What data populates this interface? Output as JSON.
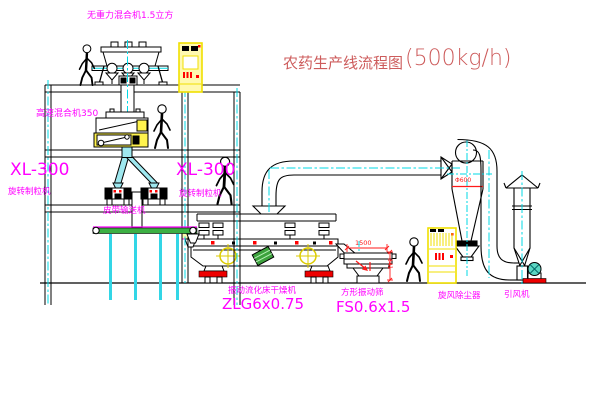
{
  "title": {
    "text": "农药生产线流程图",
    "capacity": "(500kg/h)"
  },
  "labels": {
    "mixer_top": "无重力混合机1.5立方",
    "mixer_highspeed": "高速混合机350",
    "granulator_left_model": "XL-300",
    "granulator_left_name": "旋转制粒机",
    "granulator_right_model": "XL-300",
    "granulator_right_name": "旋转制粒机",
    "belt_conveyor": "皮带输送机",
    "dryer_name": "振动流化床干燥机",
    "dryer_model": "ZLG6x0.75",
    "screen_name": "方形振动筛",
    "screen_model": "FS0.6x1.5",
    "cyclone": "旋风除尘器",
    "fan": "引风机"
  },
  "dimensions": {
    "cyclone_dia": "Φ600",
    "screen_length": "1500",
    "screen_height": "341"
  },
  "colors": {
    "label": "#FF00FF",
    "title": "#CD5C5C",
    "line": "#000000",
    "centerline": "#00D9E6",
    "accent": "#FF0000",
    "cabinet": "#F0DF00",
    "chute_fill": "#9FE8EF",
    "belt_green": "#3CB043"
  }
}
